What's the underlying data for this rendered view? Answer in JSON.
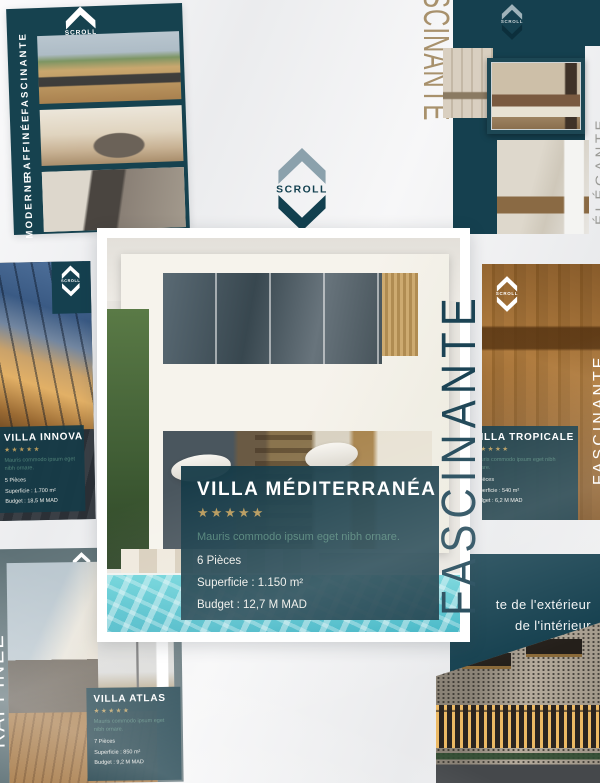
{
  "brand": {
    "name": "SCROLL",
    "logo_text": "SCROLL"
  },
  "colors": {
    "teal_dark": "#15404F",
    "card_teal": "#163B48",
    "gold_stars": "#B79A5C",
    "desc_green": "#4F8177",
    "tan_word": "#A8916C",
    "pool_turquoise": "#3DB4C4"
  },
  "tiles": {
    "top_left": {
      "words": [
        "FASCINANTE",
        "RAFFINÉE",
        "MODERNE"
      ]
    },
    "top_right": {
      "vertical_word": "SCINANTE",
      "edge_word": "ÉLÉGANTE"
    },
    "center": {
      "vertical_word": "FASCINANTE",
      "card": {
        "title": "VILLA MÉDITERRANÉA",
        "stars": "★★★★★",
        "description": "Mauris commodo ipsum eget nibh ornare.",
        "details": [
          "6 Pièces",
          "Superficie : 1.150 m²",
          "Budget : 12,7 M MAD"
        ]
      }
    },
    "left": {
      "card": {
        "title": "VILLA INNOVA",
        "stars": "★★★★★",
        "description": "Mauris commodo ipsum eget nibh ornare.",
        "details": [
          "5 Pièces",
          "Superficie : 1.700 m²",
          "Budget : 18,5 M MAD"
        ]
      }
    },
    "right": {
      "edge_word": "FASCINANTE",
      "card": {
        "title": "VILLA TROPICALE",
        "stars": "★★★★★",
        "description": "Mauris commodo ipsum eget nibh ornare.",
        "details": [
          "5 Pièces",
          "Superficie : 540 m²",
          "Budget : 6,2 M MAD"
        ]
      }
    },
    "bottom_left": {
      "edge_word": "RAFFINÉE",
      "card": {
        "title": "VILLA ATLAS",
        "stars": "★★★★★",
        "description": "Mauris commodo ipsum eget nibh ornare.",
        "details": [
          "7 Pièces",
          "Superficie : 850 m²",
          "Budget : 9,2 M MAD"
        ]
      }
    },
    "bottom_right": {
      "lines": [
        "te de l'extérieur",
        "de l'intérieur"
      ]
    }
  }
}
